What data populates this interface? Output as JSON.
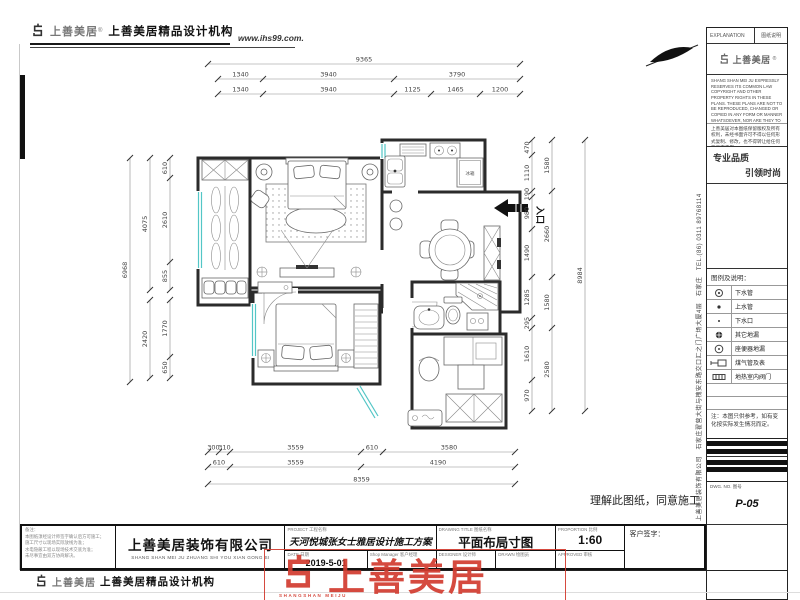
{
  "header": {
    "logo_text": "上善美居",
    "logo_reg": "®",
    "brand_line": "上善美居精品设计机构",
    "website": "www.ihs99.com."
  },
  "plan": {
    "entry_label": "入口",
    "fridge_label": "冰箱"
  },
  "dims": {
    "top": {
      "total": [
        "9365"
      ],
      "row1": [
        "1340",
        "3940",
        "3790"
      ],
      "row2": [
        "1340",
        "3940",
        "1125",
        "1465",
        "1200"
      ]
    },
    "bottom": {
      "row1": [
        "300",
        "310",
        "3559",
        "610",
        "3580"
      ],
      "row2": [
        "610",
        "3559",
        "4190"
      ],
      "total": [
        "8359"
      ]
    },
    "left": {
      "segs_upper": [
        "610",
        "2610",
        "855"
      ],
      "segs_lower": [
        "1770",
        "650"
      ],
      "mid_upper": [
        "4075"
      ],
      "mid_lower": [
        "2420"
      ],
      "total": [
        "6968"
      ]
    },
    "right": {
      "segs": [
        "470",
        "1110",
        "190",
        "980",
        "1490",
        "1285",
        "295",
        "1610",
        "970"
      ],
      "mid": [
        "1580",
        "2660",
        "1580",
        "2580"
      ],
      "total": [
        "8984"
      ]
    }
  },
  "agreement_note": "理解此图纸，同意施工",
  "right_panel": {
    "explanation_en": "EXPLANATION",
    "explanation_cn": "图纸说明",
    "logo_text": "上善美居",
    "logo_reg": "®",
    "copyright_en": "SHANG SHAN MEI JU EXPRESSLY RESERVES ITS COMMON LAW COPYRIGHT AND OTHER PROPERTY RIGHTS IN THESE PLANS. THESE PLANS ARE NOT TO BE REPRODUCED, CHANGED OR COPIED IN ANY FORM OR MANNER WHATSOEVER, NOR ARE THEY TO BE ASSIGNED TO ANY THIRD PARTY WITHOUT FIRST OBTAINING THE EXPRESSED WRITTEN PERMISSION AND CONSENT OF SHANGSHANMEIJU.",
    "copyright_cn": "上善美居对本图纸保留版权及所有权利，未经书面许可不得以任何形式复制、修改，也不得转让给任何第三方使用。",
    "slogan_1": "专业品质",
    "slogan_2": "引领时尚",
    "legend_title": "图例及说明：",
    "legend": [
      {
        "symbol": "drain-pipe-icon",
        "label": "下水管"
      },
      {
        "symbol": "supply-pipe-icon",
        "label": "上水管"
      },
      {
        "symbol": "drain-outlet-icon",
        "label": "下水口"
      },
      {
        "symbol": "other-floor-drain-icon",
        "label": "其它地漏"
      },
      {
        "symbol": "toilet-floor-drain-icon",
        "label": "座便器地漏"
      },
      {
        "symbol": "gas-pipe-meter-icon",
        "label": "煤气管及表"
      },
      {
        "symbol": "floor-heating-valve-icon",
        "label": "地热室内阀门"
      }
    ],
    "reference_note": "注：本图只供参考，如有变化按实际发生情况而定。",
    "dwg_label": "DWG. NO. 图号",
    "dwg_no": "P-05"
  },
  "company_vertical": "上善美居装饰有限公司　石家庄翟营大街与槐安东路交口汇之门广场大厦4层　石家庄　TEL.(86) 0311 89768114",
  "title_block": {
    "remark_label": "备注：",
    "remark_lines": [
      "本图纸须经设计师签字确认后方可施工；",
      "施工尺寸以现场实际放线为准；",
      "水电隐蔽工程以现场技术交底为准；",
      "未尽事宜由双方协商解决。"
    ],
    "company_name": "上善美居装饰有限公司",
    "company_pinyin": "SHANG SHAN MEI JU ZHUANG SHI YOU XIAN GONG SI",
    "project_label": "PROJECT  工程名称",
    "project_value": "天河悦城张女士雅居设计施工方案",
    "date_label": "DATE  日期",
    "date_value": "2019-5-01",
    "manager_label": "Shop Manager  客户经理",
    "title_label": "DRAWING TITLE  图纸名称",
    "title_value": "平面布局寸图",
    "designer_label": "DESIGNER  设计师",
    "drawn_label": "DRAWN  绘图员",
    "scale_label": "PROPORTION  比例",
    "scale_value": "1:60",
    "approved_label": "APPROVED  审核",
    "signature_label": "客户签字："
  },
  "footer": {
    "logo_text": "上善美居",
    "brand_line": "上善美居精品设计机构"
  },
  "stamp": {
    "text": "上善美居",
    "subtext": "SHANGSHAN MEIJU"
  },
  "colors": {
    "wall": "#2b2b2b",
    "window": "#53c6c6",
    "stamp": "#d23b2f"
  }
}
